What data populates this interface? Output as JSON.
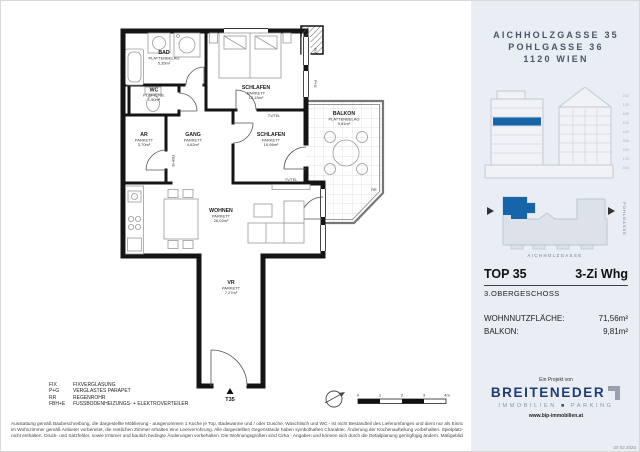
{
  "header": {
    "lines": [
      "AICHHOLZGASSE 35",
      "POHLGASSE 36",
      "1120 WIEN"
    ]
  },
  "elevation": {
    "levels": [
      "2.00",
      "1.00",
      "6.00",
      "5.00",
      "4.00",
      "3.00",
      "2.00",
      "1.00",
      "0.00"
    ]
  },
  "site": {
    "street_bottom": "AICHHOLZGASSE",
    "street_right": "POHLGASSE"
  },
  "unit": {
    "top": "TOP 35",
    "type": "3-Zi Whg",
    "floor": "3.OBERGESCHOSS",
    "rows": [
      {
        "label": "WOHNNUTZFLÄCHE:",
        "value": "71,56m²"
      },
      {
        "label": "BALKON:",
        "value": "9,81m²"
      }
    ]
  },
  "logo": {
    "pre": "Ein Projekt von",
    "name": "BREITENEDER",
    "tag_left": "IMMOBILIEN",
    "separator": "■",
    "tag_right": "PARKING",
    "url": "www.bip-immobilien.at"
  },
  "date": "20 02 2020",
  "plan": {
    "rooms": [
      {
        "name": "BAD",
        "finish": "PLATTENBELAG",
        "area": "5,35m²"
      },
      {
        "name": "WC",
        "finish": "PLATTENB.",
        "area": "1,50m²"
      },
      {
        "name": "AR",
        "finish": "PARKETT",
        "area": "3,70m²"
      },
      {
        "name": "GANG",
        "finish": "PARKETT",
        "area": "4,62m²"
      },
      {
        "name": "SCHLAFEN",
        "finish": "PARKETT",
        "area": "12,15m²"
      },
      {
        "name": "SCHLAFEN",
        "finish": "PARKETT",
        "area": "10,95m²"
      },
      {
        "name": "BALKON",
        "finish": "PLATTENBELAG",
        "area": "9,81m²"
      },
      {
        "name": "WOHNEN",
        "finish": "PARKETT",
        "area": "26,02m²"
      },
      {
        "name": "VR",
        "finish": "PARKETT",
        "area": "7,27m²"
      }
    ],
    "annotations": {
      "entrance": "T35",
      "tv": "TV/TEL",
      "fix": "FIX",
      "parapet": "P+G",
      "rainpipe": "RR",
      "heating": "FBH+E"
    }
  },
  "legend": {
    "items": [
      {
        "abbr": "FIX",
        "text": "FIXVERGLASUNG"
      },
      {
        "abbr": "P+G",
        "text": "VERGLASTES PARAPET"
      },
      {
        "abbr": "RR",
        "text": "REGENROHR"
      },
      {
        "abbr": "FBH+E",
        "text": "FUSSBODENHEIZUNGS- + ELEKTROVERTEILER"
      }
    ]
  },
  "disclaimer": {
    "lines": [
      "Ausstattung gemäß Baubeschreibung, die dargestellte Möblierung - ausgenommen 1 Küche je Top, Badewanne und / oder Dusche, Waschtisch und WC - ist nicht Bestandteil des Lieferumfanges und dient nur als Einrichtungsvorschlag. Ein TV/Tel- Anschluss",
      "im Wohnzimmer gemäß Anbieter vorbereitet, die restlichen Zimmer erhalten eine Leerverrohrung. Alle dargestellten Gegenstände haben symbolhaften Charakter. Änderung der Küchenaufteilung vorbehalten. Spielplatz- und Gartengestaltung im Kaufpreis",
      "nicht enthalten. Druck- und Satzfehler, sowie Irrtümer und baulich bedingte Änderungen vorbehalten. Die Wohnungsgrößen sind Cirka - Angaben und können sich durch die Detailplanung geringfügig ändern. Maßgeblich ist in jedem Fall der Kaufvertrag."
    ]
  },
  "scale": {
    "ticks": [
      "0",
      "1",
      "2",
      "3",
      "4m"
    ]
  },
  "colors": {
    "accent": "#1565a8",
    "navy": "#1d3c78",
    "sidebar_bg": "#e9edf4"
  }
}
